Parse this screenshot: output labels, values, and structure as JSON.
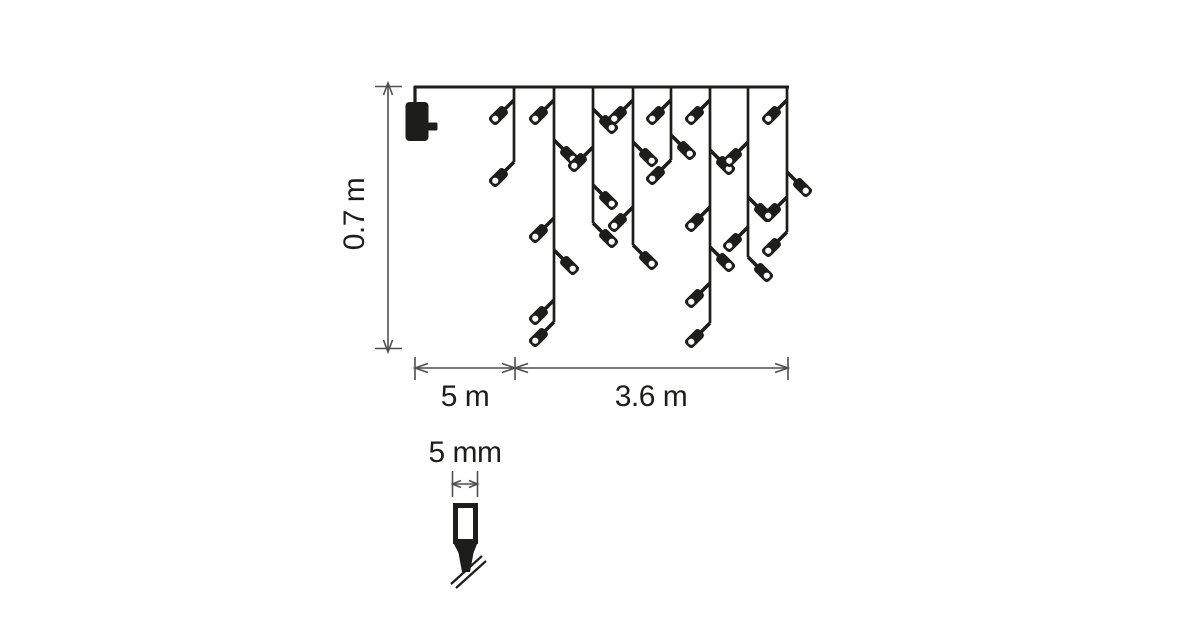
{
  "title": "Icicle string lights dimension diagram",
  "colors": {
    "ink": "#1d1d1b",
    "dim": "#4f4f4f",
    "bg": "#ffffff"
  },
  "labels": {
    "height": "0.7 m",
    "lead": "5 m",
    "lights_width": "3.6 m",
    "bulb_width": "5 mm"
  },
  "diagram": {
    "cable": {
      "x1": 414,
      "x2": 789,
      "y": 87
    },
    "plug": {
      "cord_x": 415,
      "body_x": 405.5,
      "body_y": 102,
      "body_w": 23,
      "body_h": 39,
      "prong_x": 428,
      "prong_y": 122.5,
      "prong_w": 9.5,
      "prong_h": 8
    },
    "drops": [
      {
        "x": 514,
        "len": 75,
        "end": "L",
        "bulbs": [
          {
            "o": 13,
            "s": "L"
          }
        ]
      },
      {
        "x": 554,
        "len": 235,
        "end": "L",
        "bulbs": [
          {
            "o": 13,
            "s": "L"
          },
          {
            "o": 53,
            "s": "R"
          },
          {
            "o": 131,
            "s": "L"
          },
          {
            "o": 163,
            "s": "R"
          },
          {
            "o": 213,
            "s": "L"
          }
        ]
      },
      {
        "x": 593,
        "len": 136,
        "end": "R",
        "bulbs": [
          {
            "o": 22,
            "s": "R"
          },
          {
            "o": 60,
            "s": "L"
          },
          {
            "o": 98,
            "s": "R"
          }
        ]
      },
      {
        "x": 633,
        "len": 158,
        "end": "R",
        "bulbs": [
          {
            "o": 13,
            "s": "L"
          },
          {
            "o": 55,
            "s": "R"
          },
          {
            "o": 120,
            "s": "L"
          }
        ]
      },
      {
        "x": 671,
        "len": 73,
        "end": "L",
        "bulbs": [
          {
            "o": 13,
            "s": "L"
          },
          {
            "o": 48,
            "s": "R"
          }
        ]
      },
      {
        "x": 710,
        "len": 236,
        "end": "L",
        "bulbs": [
          {
            "o": 13,
            "s": "L"
          },
          {
            "o": 63,
            "s": "R"
          },
          {
            "o": 120,
            "s": "L"
          },
          {
            "o": 160,
            "s": "R"
          },
          {
            "o": 196,
            "s": "L"
          }
        ]
      },
      {
        "x": 748,
        "len": 170,
        "end": "R",
        "bulbs": [
          {
            "o": 55,
            "s": "L"
          },
          {
            "o": 110,
            "s": "R"
          },
          {
            "o": 140,
            "s": "L"
          }
        ]
      },
      {
        "x": 787,
        "len": 145,
        "end": "L",
        "bulbs": [
          {
            "o": 13,
            "s": "L"
          },
          {
            "o": 85,
            "s": "R"
          },
          {
            "o": 110,
            "s": "L"
          }
        ]
      }
    ],
    "height_dim": {
      "x": 388,
      "y1": 83,
      "y2": 351
    },
    "width_dim": {
      "y": 368,
      "x1": 415,
      "x_mid": 515,
      "x2": 788
    },
    "bulb_detail": {
      "cx": 465,
      "tick_x1": 452.5,
      "tick_x2": 477.5,
      "arrow_y": 484,
      "rect": [
        453,
        503,
        25,
        41
      ]
    }
  }
}
